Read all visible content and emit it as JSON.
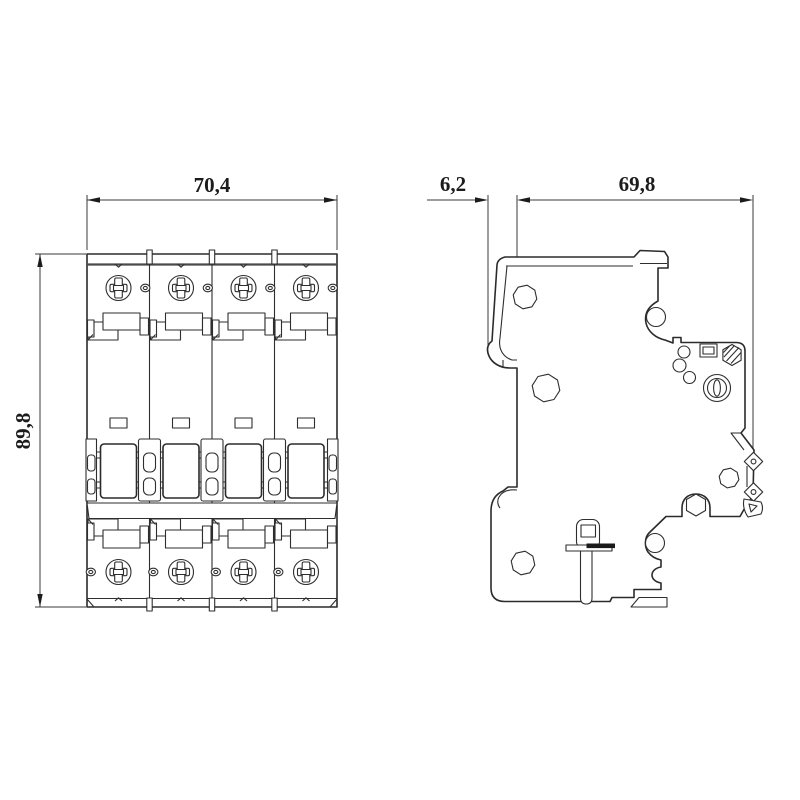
{
  "drawing": {
    "dimensions": {
      "front_width": "70,4",
      "front_height": "89,8",
      "clip_depth": "6,2",
      "body_depth": "69,8"
    },
    "colors": {
      "line": "#2b2b2b",
      "background": "#ffffff",
      "dim_text": "#1c1c1c"
    }
  }
}
